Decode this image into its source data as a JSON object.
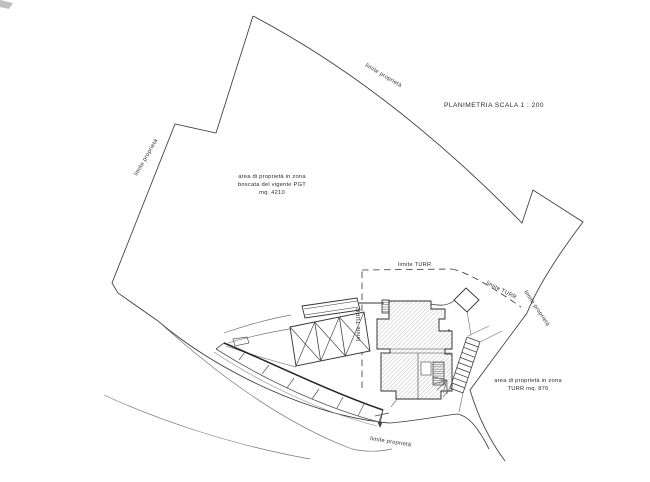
{
  "drawing": {
    "title": "PLANIMETRIA SCALA  1 : 200",
    "area_boscata": {
      "line1": "area di proprietà in zona",
      "line2": "boscata del vigente PGT",
      "line3": "mq. 4210"
    },
    "area_turr": {
      "line1": "area di proprietà in zona",
      "line2": "TURR  mq. 876"
    },
    "labels": {
      "limite_proprieta_left": "limite proprietà",
      "limite_proprieta_top": "limite proprietà",
      "limite_proprieta_right": "limite proprietà",
      "limite_proprieta_bottom": "limite proprietà",
      "limite_turr_h": "limite TURR",
      "limite_turr_diag": "limite TURR",
      "limite_turr_v": "limite TURR"
    },
    "colors": {
      "line": "#3a3a3a",
      "light_line": "#737373",
      "hatch": "#bcbcbc",
      "dense_hatch": "#5f5f5f",
      "background": "#ffffff"
    }
  }
}
